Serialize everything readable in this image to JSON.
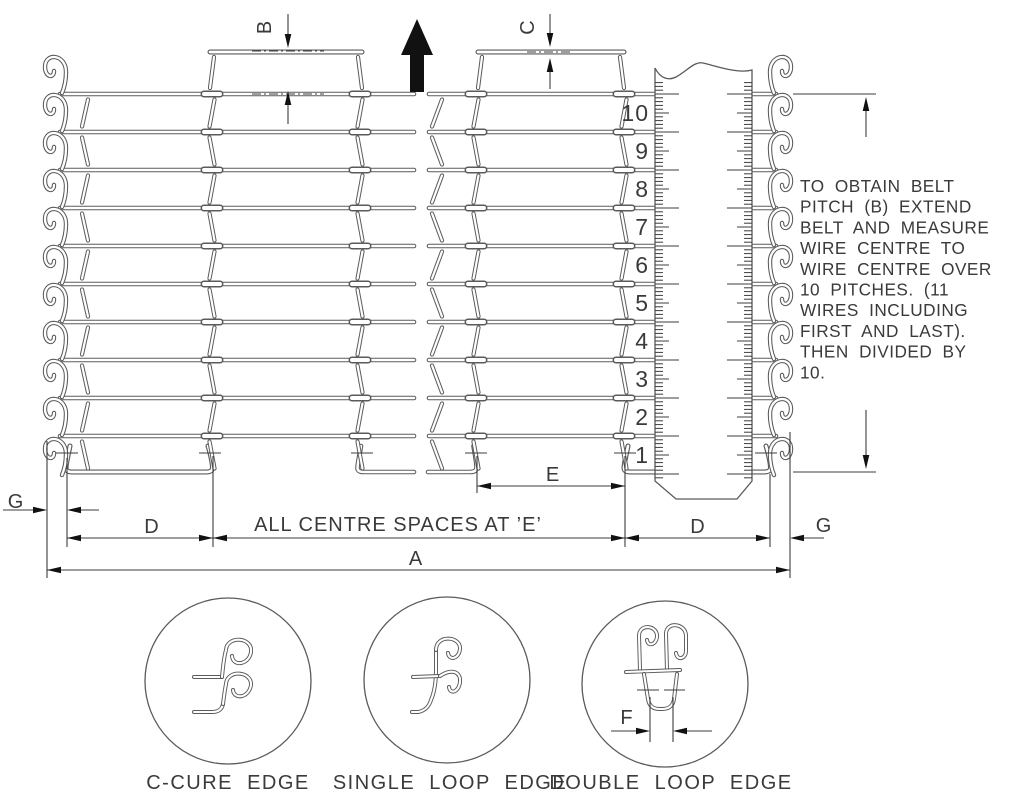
{
  "note": {
    "lines": [
      "TO OBTAIN BELT",
      "PITCH (B) EXTEND",
      "BELT AND MEASURE",
      "WIRE CENTRE TO",
      "WIRE CENTRE OVER",
      "10 PITCHES. (11",
      "WIRES INCLUDING",
      "FIRST AND LAST).",
      "THEN DIVIDED BY",
      "10."
    ]
  },
  "ruler": {
    "numbers": [
      "10",
      "9",
      "8",
      "7",
      "6",
      "5",
      "4",
      "3",
      "2",
      "1"
    ]
  },
  "dimensions": {
    "a": "A",
    "b": "B",
    "c": "C",
    "d": "D",
    "e": "E",
    "f": "F",
    "g": "G",
    "centre_note": "ALL CENTRE SPACES AT ’E’"
  },
  "edges": [
    {
      "label": "C-CURE EDGE"
    },
    {
      "label": "SINGLE LOOP EDGE"
    },
    {
      "label": "DOUBLE LOOP EDGE"
    }
  ],
  "icons": {
    "direction_arrow": "belt-travel-up-arrow"
  },
  "colors": {
    "wire_line": "#5a5a5a",
    "dimension_line": "#3c3c3c",
    "text": "#3a3a3a",
    "arrow_fill": "#111111",
    "background": "#ffffff"
  }
}
